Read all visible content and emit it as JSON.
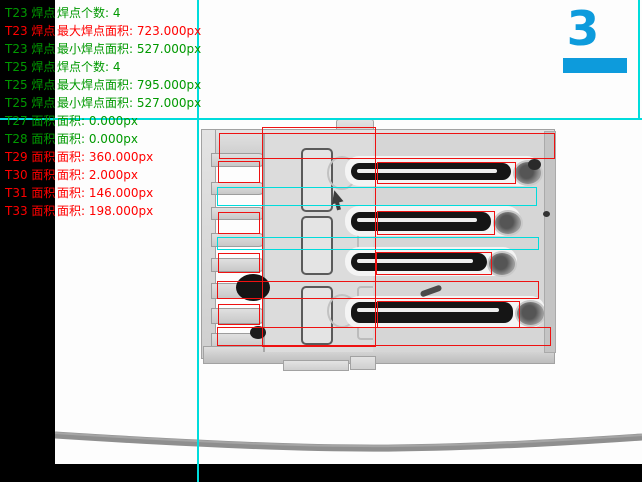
{
  "measurement_panel": {
    "lines": [
      {
        "tool": "T23 焊点",
        "text": "焊点个数: 4",
        "status": "pass"
      },
      {
        "tool": "T23 焊点",
        "text": "最大焊点面积: 723.000px",
        "status": "fail"
      },
      {
        "tool": "T23 焊点",
        "text": "最小焊点面积: 527.000px",
        "status": "pass"
      },
      {
        "tool": "T25 焊点",
        "text": "焊点个数: 4",
        "status": "pass"
      },
      {
        "tool": "T25 焊点",
        "text": "最大焊点面积: 795.000px",
        "status": "pass"
      },
      {
        "tool": "T25 焊点",
        "text": "最小焊点面积: 527.000px",
        "status": "pass"
      },
      {
        "tool": "T27 面积",
        "text": "面积: 0.000px",
        "status": "pass"
      },
      {
        "tool": "T28 面积",
        "text": "面积: 0.000px",
        "status": "pass"
      },
      {
        "tool": "T29 面积",
        "text": "面积: 360.000px",
        "status": "fail"
      },
      {
        "tool": "T30 面积",
        "text": "面积: 2.000px",
        "status": "fail"
      },
      {
        "tool": "T31 面积",
        "text": "面积: 146.000px",
        "status": "fail"
      },
      {
        "tool": "T33 面积",
        "text": "面积: 198.000px",
        "status": "fail"
      }
    ]
  },
  "station_counter": {
    "value": "3"
  },
  "colors": {
    "pass_green": "#009900",
    "fail_red": "#ff0000",
    "roi_red": "#ee1111",
    "crosshair_cyan": "#00dcdc",
    "counter_blue": "#0d9bdc"
  }
}
